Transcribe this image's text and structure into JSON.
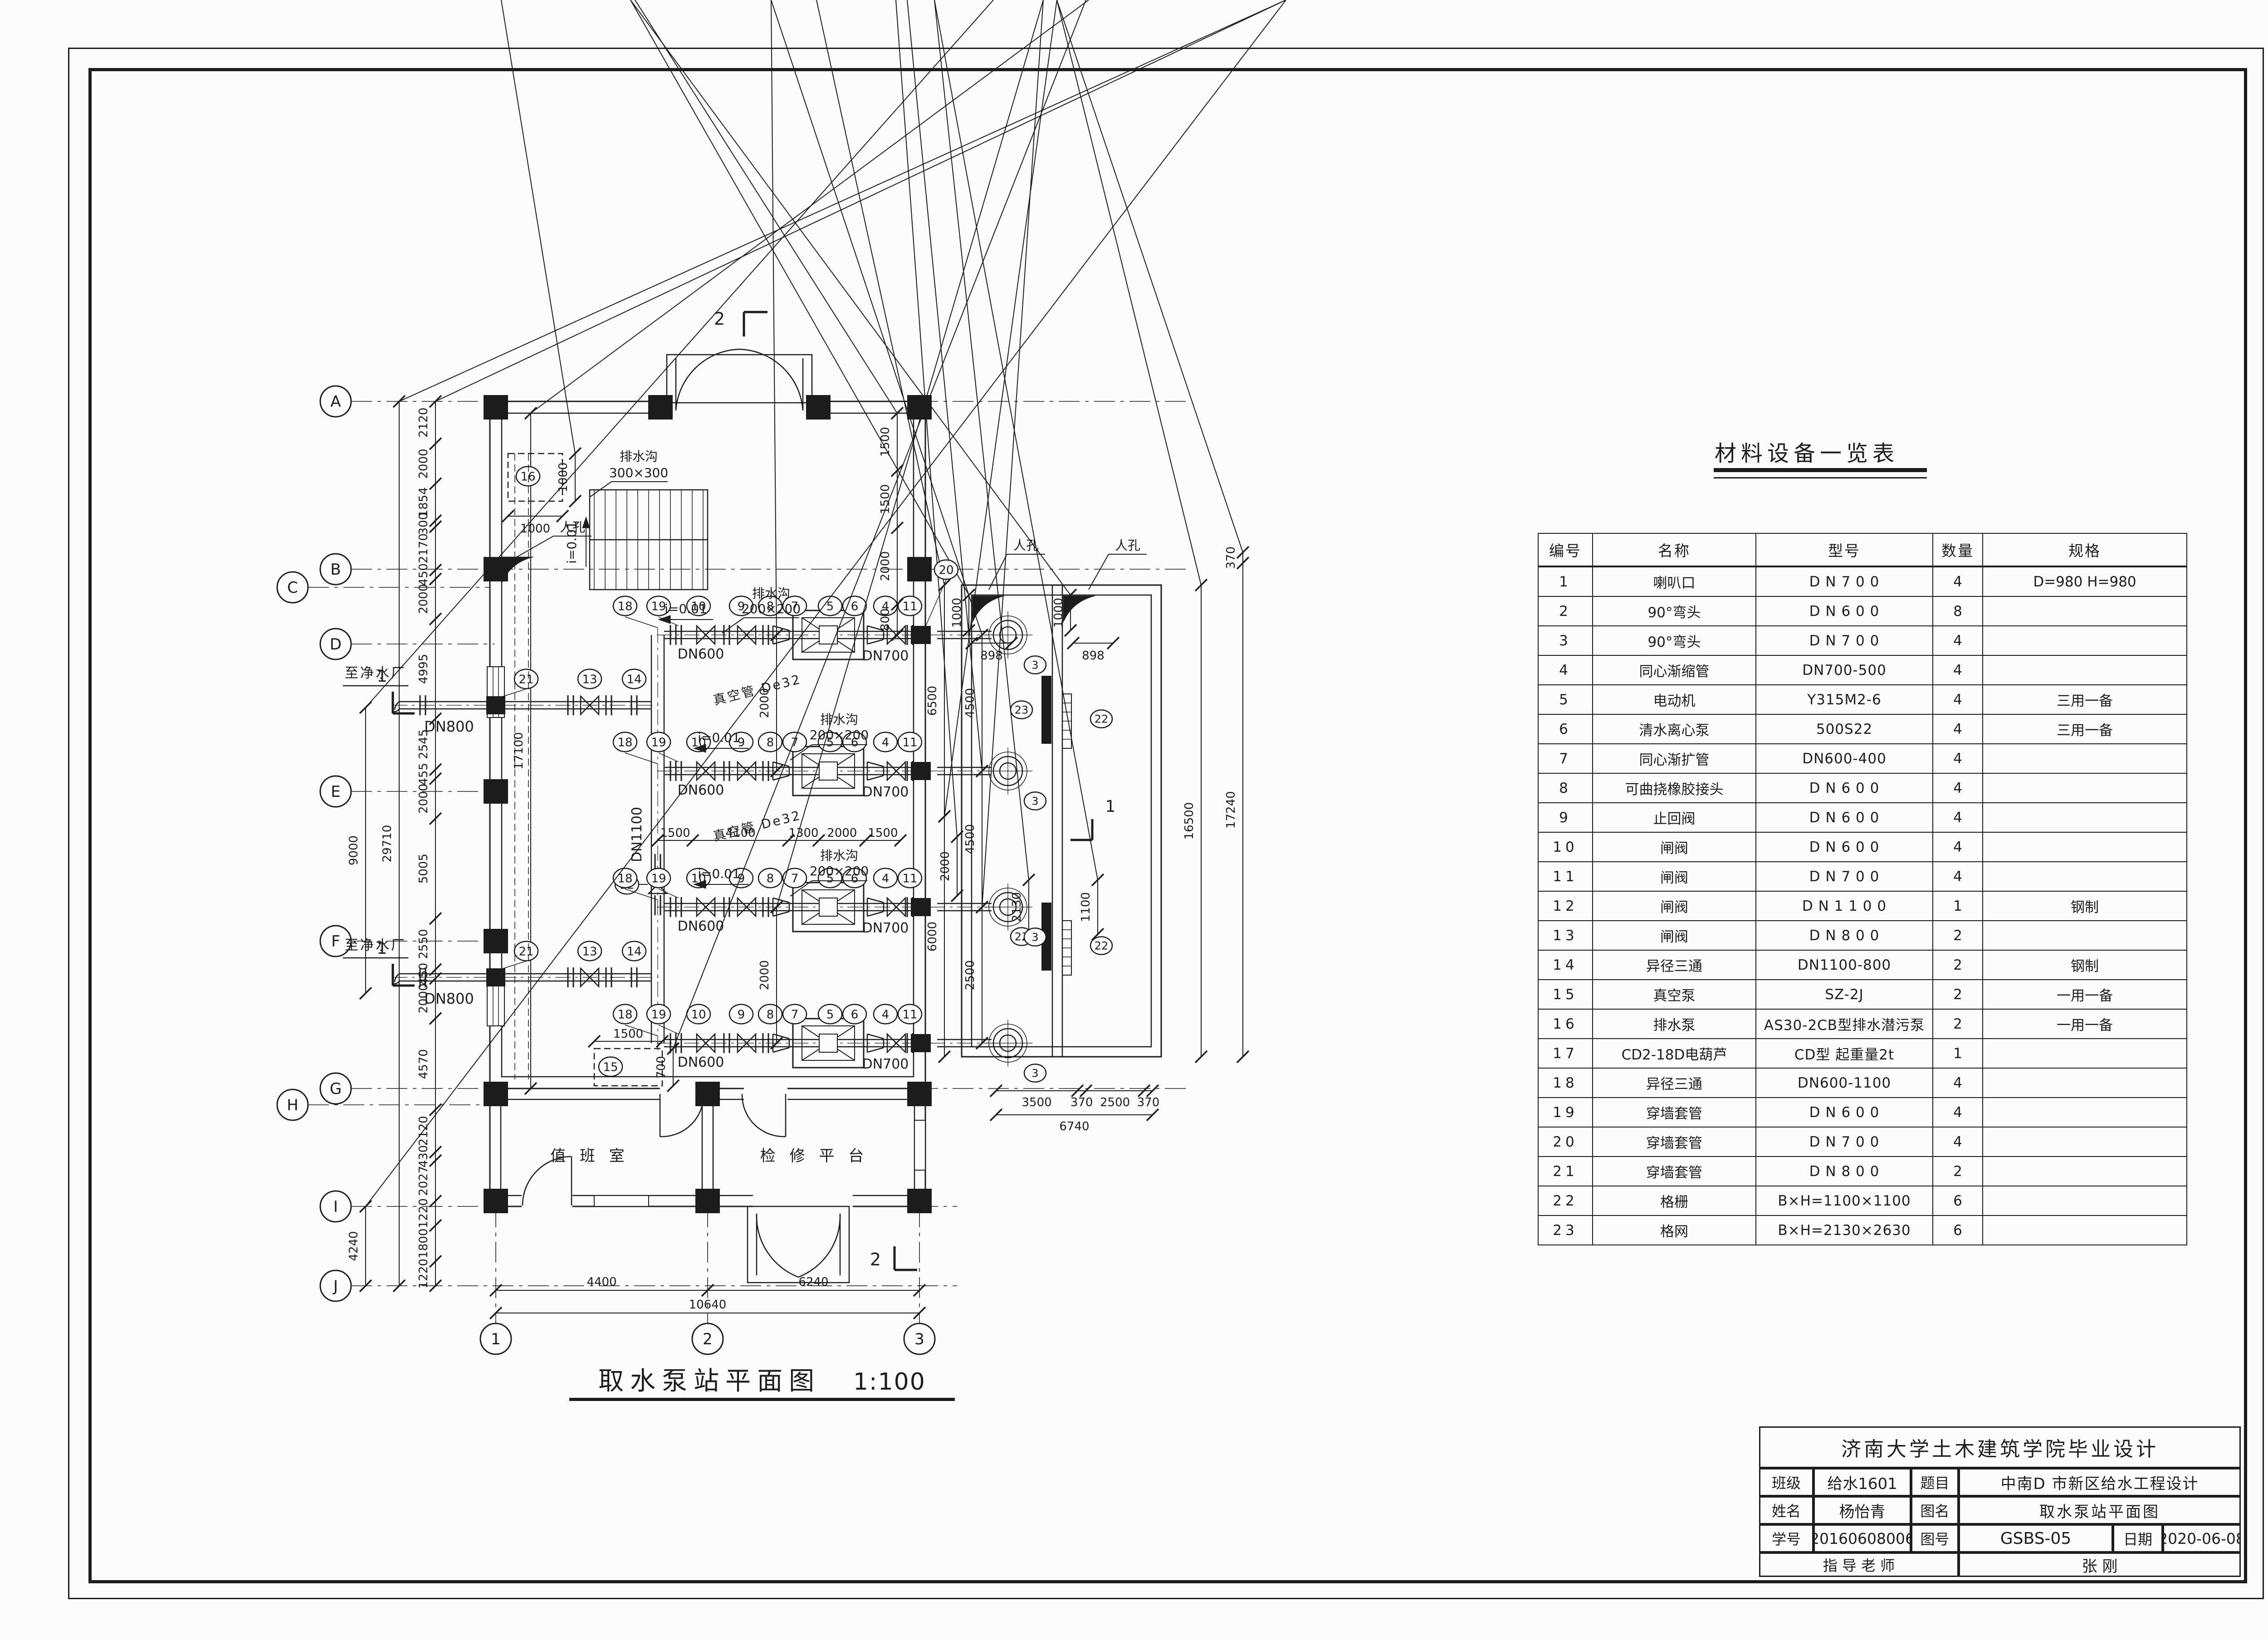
{
  "materials_table": {
    "title": "材料设备一览表",
    "headers": [
      "编号",
      "名称",
      "型号",
      "数量",
      "规格"
    ],
    "rows": [
      [
        "1",
        "喇叭口",
        "D N 7 0 0",
        "4",
        "D=980  H=980"
      ],
      [
        "2",
        "90°弯头",
        "D N 6 0 0",
        "8",
        ""
      ],
      [
        "3",
        "90°弯头",
        "D N 7 0 0",
        "4",
        ""
      ],
      [
        "4",
        "同心渐缩管",
        "DN700-500",
        "4",
        ""
      ],
      [
        "5",
        "电动机",
        "Y315M2-6",
        "4",
        "三用一备"
      ],
      [
        "6",
        "清水离心泵",
        "500S22",
        "4",
        "三用一备"
      ],
      [
        "7",
        "同心渐扩管",
        "DN600-400",
        "4",
        ""
      ],
      [
        "8",
        "可曲挠橡胶接头",
        "D N 6 0 0",
        "4",
        ""
      ],
      [
        "9",
        "止回阀",
        "D N 6 0 0",
        "4",
        ""
      ],
      [
        "10",
        "闸阀",
        "D N 6 0 0",
        "4",
        ""
      ],
      [
        "11",
        "闸阀",
        "D N 7 0 0",
        "4",
        ""
      ],
      [
        "12",
        "闸阀",
        "D N 1 1 0 0",
        "1",
        "钢制"
      ],
      [
        "13",
        "闸阀",
        "D N 8 0 0",
        "2",
        ""
      ],
      [
        "14",
        "异径三通",
        "DN1100-800",
        "2",
        "钢制"
      ],
      [
        "15",
        "真空泵",
        "SZ-2J",
        "2",
        "一用一备"
      ],
      [
        "16",
        "排水泵",
        "AS30-2CB型排水潜污泵",
        "2",
        "一用一备"
      ],
      [
        "17",
        "CD2-18D电葫芦",
        "CD型  起重量2t",
        "1",
        ""
      ],
      [
        "18",
        "异径三通",
        "DN600-1100",
        "4",
        ""
      ],
      [
        "19",
        "穿墙套管",
        "D N 6 0 0",
        "4",
        ""
      ],
      [
        "20",
        "穿墙套管",
        "D N 7 0 0",
        "4",
        ""
      ],
      [
        "21",
        "穿墙套管",
        "D N 8 0 0",
        "2",
        ""
      ],
      [
        "22",
        "格栅",
        "B×H=1100×1100",
        "6",
        ""
      ],
      [
        "23",
        "格网",
        "B×H=2130×2630",
        "6",
        ""
      ]
    ]
  },
  "title_block": {
    "school_line": "济南大学土木建筑学院毕业设计",
    "class_label": "班级",
    "class_value": "给水1601",
    "topic_label": "题目",
    "topic_value": "中南D 市新区给水工程设计",
    "name_label": "姓名",
    "name_value": "杨怡青",
    "dwg_name_label": "图名",
    "dwg_name_value": "取水泵站平面图",
    "sid_label": "学号",
    "sid_value": "20160608006",
    "dwg_no_label": "图号",
    "dwg_no_value": "GSBS-05",
    "date_label": "日期",
    "date_value": "2020-06-08",
    "advisor_label": "指  导  老  师",
    "advisor_value": "张  刚"
  },
  "plan": {
    "caption": "取水泵站平面图",
    "scale": "1:100",
    "axes_left": [
      "A",
      "B",
      "C",
      "D",
      "E",
      "F",
      "G",
      "H",
      "I",
      "J"
    ],
    "axes_bottom": [
      "1",
      "2",
      "3"
    ],
    "rooms": {
      "duty": "值 班 室",
      "platform": "检 修 平 台"
    },
    "labels": {
      "to_plant": "至净水厂",
      "manhole": "人孔",
      "drain": "排水沟",
      "size300": "300×300",
      "size200": "200×200",
      "slope": "i=0.01",
      "vacuum_pipe": "真空管  De32",
      "dn600": "DN600",
      "dn700": "DN700",
      "dn800": "DN800",
      "dn1100": "DN1100"
    },
    "sections": {
      "s1": "1",
      "s2": "2"
    },
    "bubbles": {
      "row": [
        "18",
        "19",
        "10",
        "9",
        "8",
        "7",
        "5",
        "6",
        "4",
        "11"
      ],
      "header_valve": "12",
      "dn800": [
        "21",
        "13",
        "14"
      ],
      "bell": "3",
      "screen": "22",
      "mesh": "23",
      "sump": "16",
      "vacuum": "15",
      "sleeve": "20"
    },
    "dims": {
      "left_chain": [
        "2120",
        "2000",
        "1854",
        "300",
        "2170",
        "450",
        "2000",
        "4995",
        "2545",
        "455",
        "2000",
        "5005",
        "2550",
        "450",
        "2000",
        "4570",
        "2120",
        "430",
        "2027",
        "1220",
        "1800",
        "1220"
      ],
      "left_total": "29710",
      "left_outer": "9000",
      "left_aux": "4240",
      "inner_right": [
        "1500",
        "1500",
        "2000",
        "800"
      ],
      "mid_chain": [
        "1500",
        "4100",
        "1300",
        "2000",
        "1500"
      ],
      "header_len": "17100",
      "row_gap": "2000",
      "pit16": [
        "1000",
        "1000"
      ],
      "pit15": [
        "1500",
        "1500",
        "700"
      ],
      "corner_v": "1000",
      "corner_h": "898",
      "well_gap": [
        "6500",
        "6000"
      ],
      "well_inner": [
        "4500",
        "4500",
        "2500",
        "2000",
        "2130",
        "1100"
      ],
      "well_bottom": [
        "3500",
        "370",
        "2500",
        "370"
      ],
      "well_bottom_total": "6740",
      "right_chain": [
        "370",
        "17240"
      ],
      "right_inner": "16500",
      "bottom_row1": [
        "4400",
        "6240"
      ],
      "bottom_total": "10640"
    }
  }
}
